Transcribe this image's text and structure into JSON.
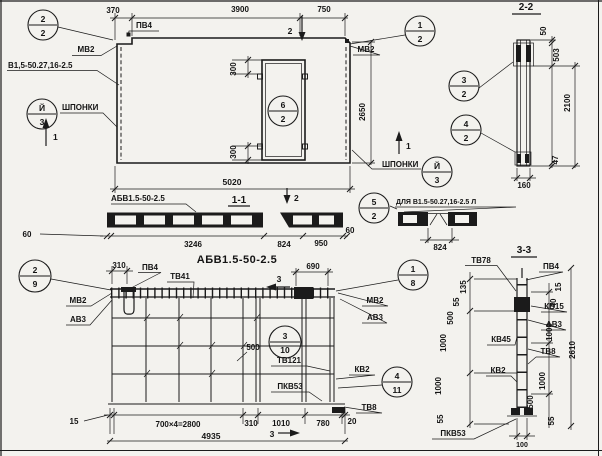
{
  "colors": {
    "paper": "#f3f2ee",
    "ink": "#1b1b1b"
  },
  "plan": {
    "dim_370": "370",
    "mark_pv4": "ПВ4",
    "dim_3900": "3900",
    "dim_750": "750",
    "mark_mv2_left": "МВ2",
    "mark_series": "В1,5-50.27,16-2.5",
    "keys_left": "ШПОНКИ",
    "keys_right": "ШПОНКИ",
    "dim_300_top": "300",
    "dim_300_bottom": "300",
    "mark_mv2_right": "МВ2",
    "dim_height": "2650",
    "dim_length": "5020",
    "cut1_left": "1",
    "cut1_right": "1",
    "cut2_top": "2",
    "cut2_bottom": "2"
  },
  "section_1_1": {
    "title": "1-1",
    "label": "АБВ1.5-50-2.5",
    "dim_60_left": "60",
    "dim_3246": "3246",
    "dim_824": "824",
    "dim_950": "950",
    "dim_60_right": "60",
    "detail_label": "ДЛЯ В1.5-50.27,16-2.5 Л",
    "detail_dim_824": "824"
  },
  "section_2_2": {
    "title": "2-2",
    "dim_50": "50",
    "dim_503": "503",
    "dim_2100": "2100",
    "dim_47": "47",
    "dim_160": "160"
  },
  "reinforcement_view": {
    "title": "АБВ1.5-50-2.5",
    "dim_310_top": "310",
    "mark_pv4": "ПВ4",
    "mark_tv41": "ТВ41",
    "mark_mv2_left": "МВ2",
    "mark_av3_left": "АВ3",
    "dim_690": "690",
    "mark_mv2_right": "МВ2",
    "mark_av3_right": "АВ3",
    "dim_500": "500",
    "mark_tv121": "ТВ121",
    "mark_kv2": "КВ2",
    "mark_pkv53": "ПКВ53",
    "mark_tv8": "ТВ8",
    "dim_15": "15",
    "dim_700x4": "700×4=2800",
    "dim_310_bottom": "310",
    "dim_1010": "1010",
    "dim_780": "780",
    "dim_20": "20",
    "dim_total": "4935",
    "cut3_top": "3",
    "cut3_bottom": "3"
  },
  "section_3_3": {
    "title": "3-3",
    "mark_tv78": "ТВ78",
    "mark_pv4": "ПВ4",
    "mark_kv15": "КВ15",
    "mark_av3": "АВ3",
    "mark_kv45": "КВ45",
    "mark_tv8": "ТВ8",
    "mark_kv2": "КВ2",
    "mark_pkv53": "ПКВ53",
    "dim_135": "135",
    "dim_55_a": "55",
    "dim_500_left": "500",
    "dim_1000_a": "1000",
    "dim_1000_b": "1000",
    "dim_55_b": "55",
    "dim_15": "15",
    "dim_40": "40",
    "dim_1000_c": "1000",
    "dim_1000_d": "1000",
    "dim_500_right": "500",
    "dim_55_c": "55",
    "dim_total": "2610",
    "dim_100": "100"
  },
  "balloons": {
    "b_2_2": {
      "top": "2",
      "bottom": "2"
    },
    "b_1_2": {
      "top": "1",
      "bottom": "2"
    },
    "b_key_left": {
      "top": "Й",
      "bottom": "3"
    },
    "b_key_right": {
      "top": "Й",
      "bottom": "3"
    },
    "b_6_2": {
      "top": "6",
      "bottom": "2"
    },
    "b_5_2": {
      "top": "5",
      "bottom": "2"
    },
    "b_3_2": {
      "top": "3",
      "bottom": "2"
    },
    "b_4_2": {
      "top": "4",
      "bottom": "2"
    },
    "b_2_9": {
      "top": "2",
      "bottom": "9"
    },
    "b_1_8": {
      "top": "1",
      "bottom": "8"
    },
    "b_3_10": {
      "top": "3",
      "bottom": "10"
    },
    "b_4_11": {
      "top": "4",
      "bottom": "11"
    }
  }
}
